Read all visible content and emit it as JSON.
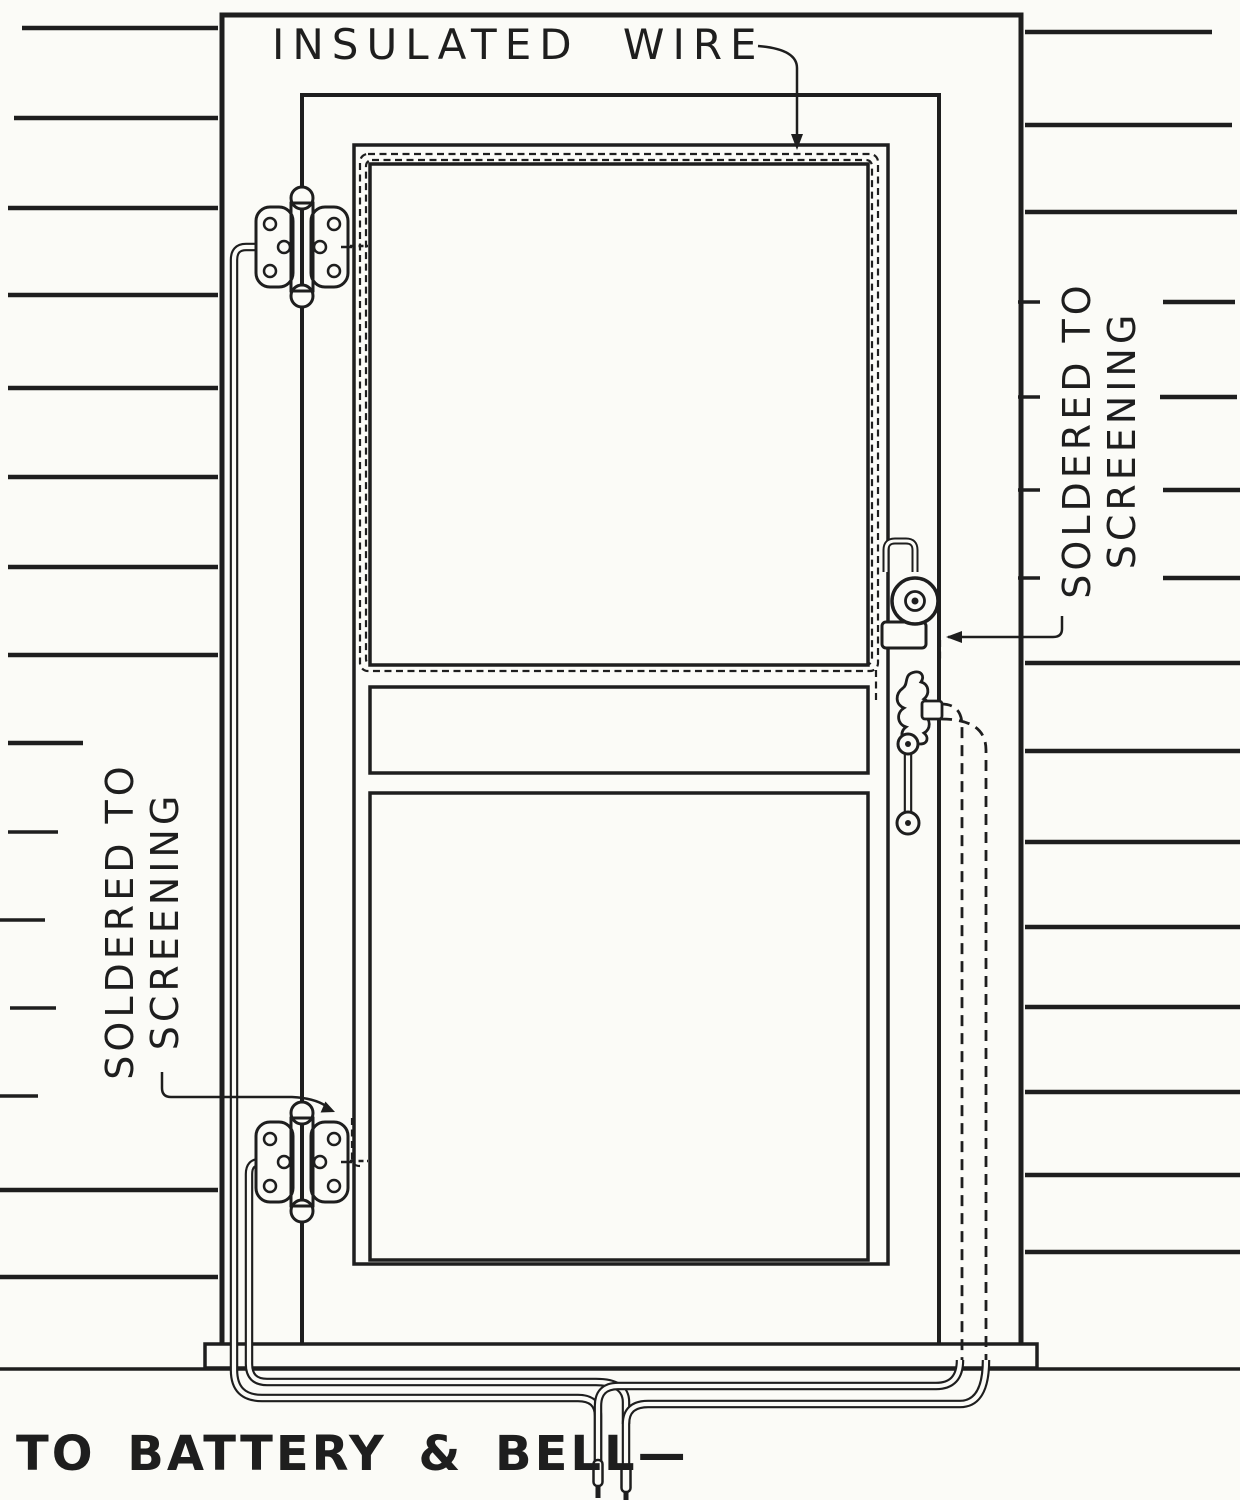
{
  "labels": {
    "insulated_wire": "INSULATED WIRE",
    "soldered_right": {
      "line1": "SOLDERED TO",
      "line2": "SCREENING"
    },
    "soldered_left": {
      "line1": "SOLDERED TO",
      "line2": "SCREENING"
    },
    "to_battery": "TO BATTERY & BELL—"
  },
  "colors": {
    "ink": "#1e1e1e",
    "paper": "#fbfbf7"
  }
}
